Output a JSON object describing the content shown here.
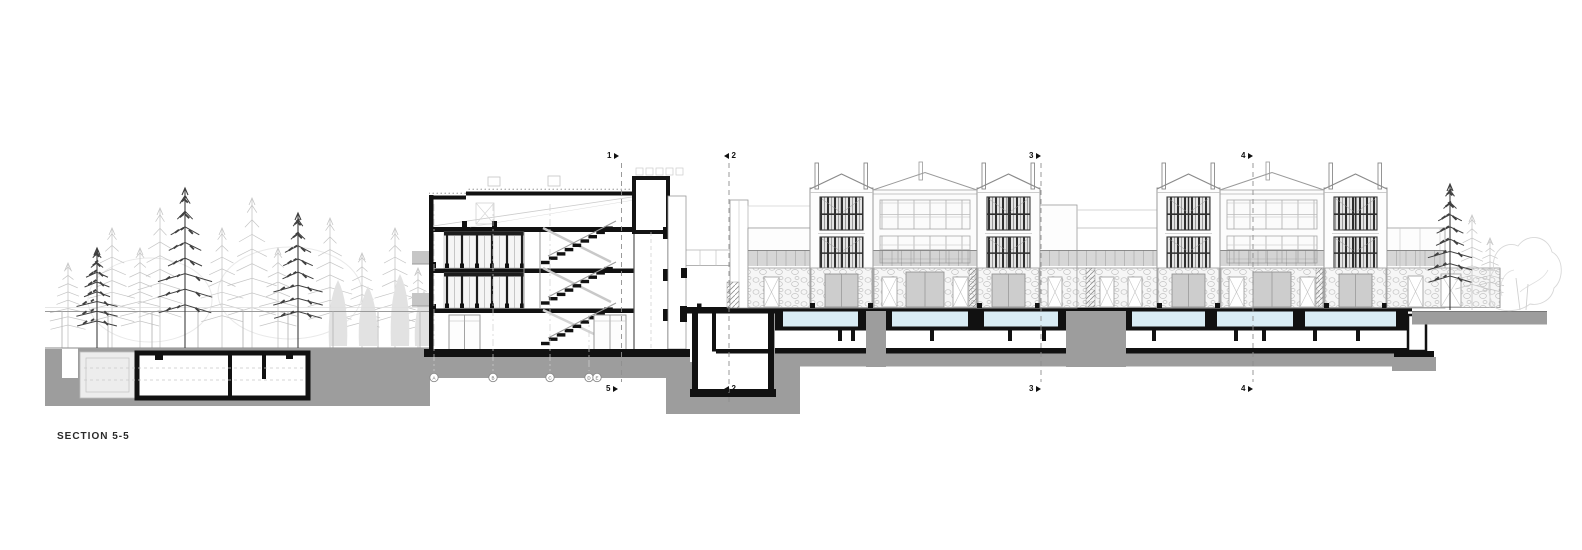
{
  "title": "SECTION 5-5",
  "colors": {
    "ink": "#161616",
    "earth_gray": "#9d9d9d",
    "pool_blue": "#d9ecf4",
    "light_tree": "#c6c6c6",
    "dark_tree": "#3f3f3f",
    "light_line": "#c8c8c8",
    "mid_line": "#9a9a9a",
    "stone_line": "#c2c2c2",
    "door_gray": "#cdcdcd",
    "railing_gray": "rgba(150,150,150,0.38)"
  },
  "section_markers": {
    "top": [
      {
        "label": "1",
        "dir": "right"
      },
      {
        "label": "2",
        "dir": "left"
      },
      {
        "label": "3",
        "dir": "right"
      },
      {
        "label": "4",
        "dir": "right"
      }
    ],
    "bottom": [
      {
        "label": "5",
        "dir": "right"
      },
      {
        "label": "2",
        "dir": "left"
      },
      {
        "label": "3",
        "dir": "right"
      },
      {
        "label": "4",
        "dir": "right"
      }
    ]
  },
  "grid_bubbles": [
    "A",
    "B",
    "C",
    "D",
    "E"
  ]
}
